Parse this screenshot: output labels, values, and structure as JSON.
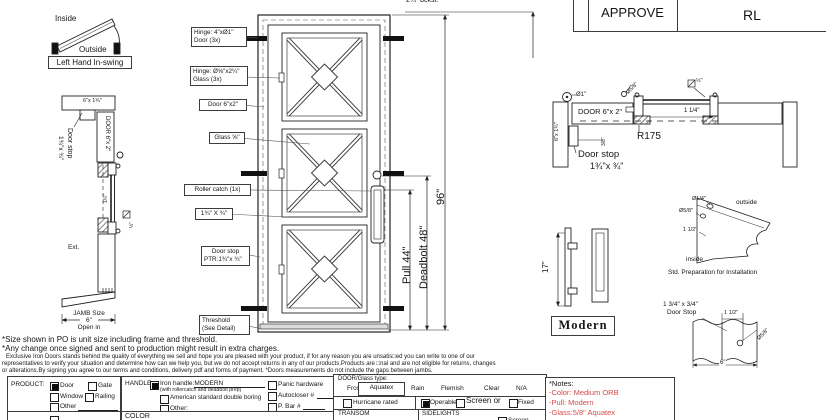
{
  "approval": {
    "approve": "APPROVE",
    "initials": "RL"
  },
  "swing": {
    "inside": "Inside",
    "outside": "Outside",
    "caption": "Left Hand In-swing"
  },
  "left_section": {
    "head": "6\"x 1¾\"",
    "door": "DOOR 6\"x 2\"",
    "stop1": "Door stop",
    "stop2": "1¾\"x ¾\"",
    "dim114": "1¼\"",
    "glass_half": "½\"",
    "ext": "Ext.",
    "jamb1": "JAMB Size",
    "jamb2": "6\"",
    "jamb3": "Open in"
  },
  "elevation": {
    "backset": "2¾\"  bckst.",
    "hinge_door1": "Hinge: 4\"xØ1\"",
    "hinge_door2": "Door (3x)",
    "hinge_glass1": "Hinge: Ø⅝\"x2¼\"",
    "hinge_glass2": "Glass (3x)",
    "door": "Door 6\"x2\"",
    "glass": "Glass ⅝\"",
    "roller": "Roller catch  (1x)",
    "stop_size": "1¾\" X ¾\"",
    "stop1": "Door stop",
    "stop2": "PTR:1¾\"x ¾\"",
    "threshold1": "Threshold",
    "threshold2": "(See Detail)",
    "pull": "Pull 44\"",
    "deadbolt": "Deadbolt 48\"",
    "height": "96\""
  },
  "section": {
    "dia1": "Ø1\"",
    "dia58": "Ø5/8\"",
    "half": "½\"",
    "door": "DOOR 6\"x 2\"",
    "jamb": "6\"x 1¾\"",
    "dim114": "1 1/4\"",
    "dim38": "3/8\"",
    "r175": "R175",
    "stop1": "Door stop",
    "stop2": "1¾\"x ¾\""
  },
  "prep": {
    "dia14": "Ø1/4\"",
    "dia58": "Ø5/8\"",
    "dim112": "1 1/2\"",
    "outside": "outside",
    "inside": "inside",
    "caption": "Std. Preparation for Installation"
  },
  "pull_detail": {
    "dim17": "17\"",
    "model": "Modern"
  },
  "stop_detail": {
    "l1": "1 3/4\" x 3/4\"",
    "l2": "Door Stop",
    "dim112": "1 1/2\"",
    "dia58": "Ø5/8\"",
    "dim6": "6\""
  },
  "disclaimer": {
    "l1": "*Size shown in PO is unit size including frame and threshold.",
    "l2": "*Any change once signed and sent to production might result in extra charges.",
    "f1": "Exclusive Iron Doors stands behind the quality of everything we sell and hope you are pleased with your product, if for any reason you are unsatis□ed you can write to one of our",
    "f2": "representatives to verify your situation and determine how can we help you, but we do not accept returns in any of our products.Products are □nal and are not eligible for returns, changes",
    "f3": "or alterations.By signing you agree to our terms and conditions, delivery pdf and forms of payment. *Doors measurements do not include the gaps between jambs."
  },
  "form": {
    "product": {
      "label": "PRODUCT:",
      "door": "Door",
      "gate": "Gate",
      "window": "Window",
      "railing": "Railing",
      "other": "Other"
    },
    "handle": {
      "label": "HANDLE",
      "iron": "Iron handle:",
      "iron_model": "MODERN",
      "iron_sub": "(with rollercatch and deadbolt prep)",
      "american": "American standard double boring",
      "other": "Other:"
    },
    "hardware": {
      "panic": "Panic hardware",
      "autocloser": "Autocloser #",
      "pbar": "P. Bar #"
    },
    "color": "COLOR",
    "glass": {
      "label": "DOOR/Glass type:",
      "frost": "Frost",
      "aquatex": "Aquatex",
      "rain": "Rain",
      "flemish": "Flemish",
      "clear": "Clear",
      "na": "N/A",
      "hurricane": "Hurricane rated",
      "operable": "Operable",
      "screen_or": "Screen or",
      "fixed": "Fixed",
      "transom": "TRANSOM",
      "sidelights": "SIDELIGHTS",
      "screen": "Screen"
    },
    "selected": {
      "product": "Door",
      "handle": "Iron handle MODERN",
      "glass_type": "Aquatex",
      "operable": true
    },
    "notes": {
      "title": "*Notes:",
      "color": "-Color: Medium ORB",
      "pull": "-Pull: Modern",
      "glass": "-Glass:5/8\"  Aquatex"
    }
  }
}
